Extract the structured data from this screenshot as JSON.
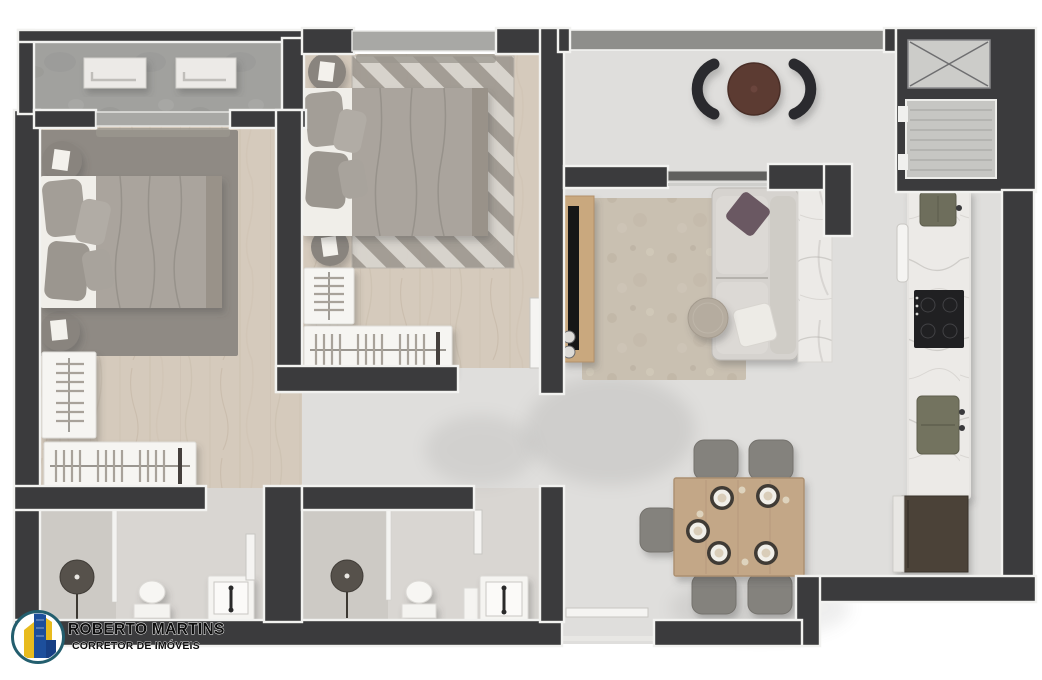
{
  "branding": {
    "name": "ROBERTO MARTINS",
    "tagline": "CORRETOR DE IMÓVEIS"
  },
  "colors": {
    "wall": "#3b3b3d",
    "trim": "#f2f2f0",
    "parapet": "#8e8e8b",
    "glass": "#a8a8a5",
    "wood": "#d5cabc",
    "hall": "#dfdedc",
    "concrete": "#a1a19e",
    "marble": "#eceae7",
    "bath": "#d9d6d2",
    "chevLight": "#d8d4cd",
    "chevDark": "#a19b93",
    "rugLiving": "#c9c0b1",
    "rugBed": "#8f8a84",
    "sofa": "#d6d3cf",
    "chair": "#84827d",
    "tableWood": "#c3a787",
    "bistro": "#5c3a33",
    "fridge": "#4c4237",
    "logoRing": "#235e6e",
    "logoBlue": "#1d4f9c",
    "logoYellow": "#e8bb1e",
    "ink": "#0d0d0d"
  },
  "plan": {
    "rooms": [
      "balcony-bedroom",
      "bedroom-suite",
      "bedroom-2",
      "hallway",
      "bathroom-ensuite",
      "bathroom-social",
      "living-room",
      "dining-area",
      "kitchen",
      "balcony-living",
      "entry",
      "elevator-shaft",
      "duct-shaft"
    ],
    "furniture": [
      "double-bed x2",
      "round-nightstand x4",
      "wardrobe-rack x4",
      "ac-unit x2",
      "bistro-table",
      "bistro-chair x2",
      "sofa",
      "tv-console",
      "tv",
      "coffee-table",
      "living-rug",
      "chevron-rug",
      "dining-table",
      "dining-chair x5",
      "place-setting x5",
      "kitchen-counter",
      "sink x2",
      "cooktop",
      "refrigerator",
      "shower x2",
      "toilet x2",
      "washbasin x2"
    ]
  }
}
